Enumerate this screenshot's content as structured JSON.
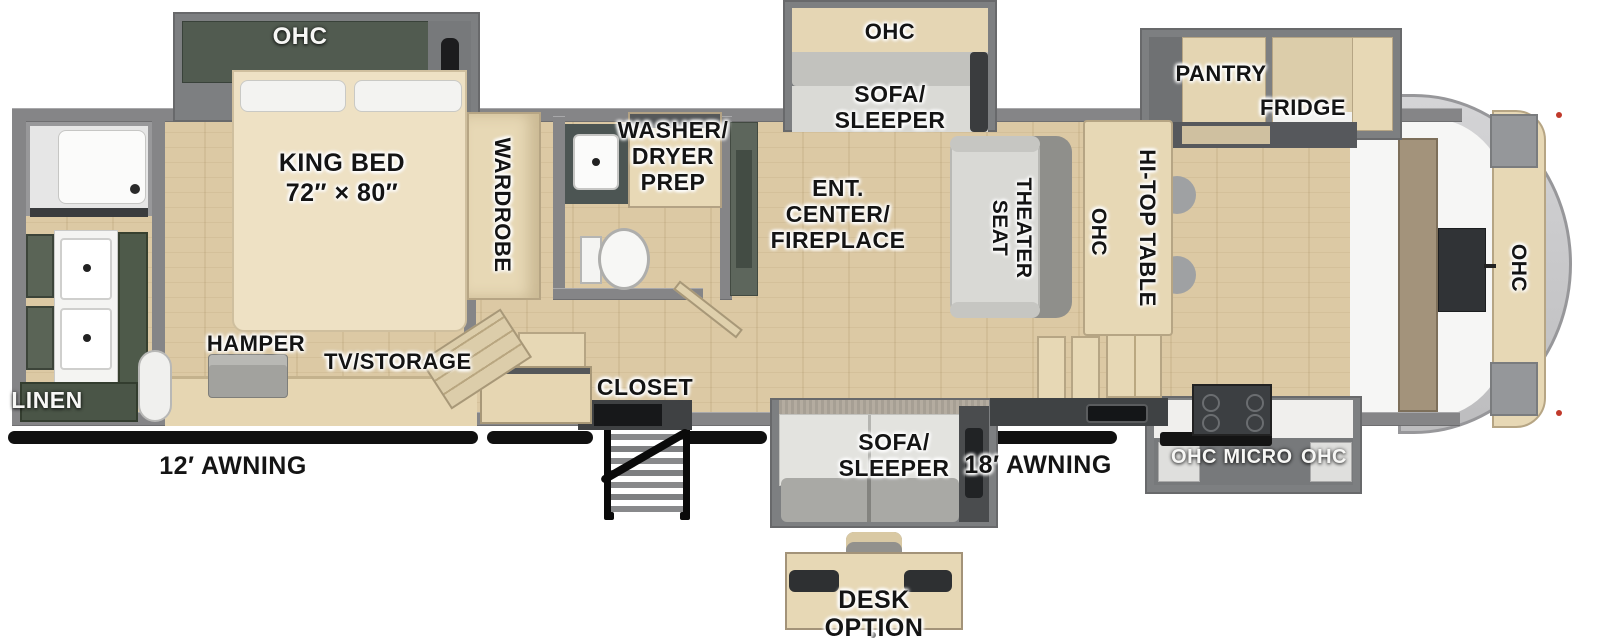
{
  "floorplan": {
    "bedroom": {
      "ohc": "OHC",
      "king_bed": "KING BED\n72″ × 80″",
      "wardrobe": "WARDROBE",
      "hamper": "HAMPER",
      "tv_storage": "TV/STORAGE"
    },
    "rear_bath": {
      "linen": "LINEN"
    },
    "mid_bath": {
      "washer_dryer": "WASHER/\nDRYER\nPREP"
    },
    "living": {
      "ent_center": "ENT.\nCENTER/\nFIREPLACE",
      "sofa_ohc": "OHC",
      "sofa_sleeper": "SOFA/\nSLEEPER",
      "theater_seat": "THEATER\nSEAT",
      "ohc": "OHC",
      "hitop_table": "HI-TOP TABLE"
    },
    "kitchen": {
      "pantry": "PANTRY",
      "fridge": "FRIDGE",
      "front_ohc": "OHC",
      "ohc_left": "OHC",
      "micro": "MICRO",
      "ohc_right": "OHC"
    },
    "entry": {
      "closet": "CLOSET"
    },
    "exterior": {
      "awning_12": "12′ AWNING",
      "awning_18": "18′ AWNING"
    },
    "options": {
      "sofa_sleeper": "SOFA/\nSLEEPER",
      "desk": "DESK OPTION"
    }
  },
  "colors": {
    "wall_gray": "#858587",
    "slide_gray": "#7d7f81",
    "floor_wood": "#dcc9a4",
    "cabinet_wood": "#e7d8b5",
    "cabinet_green": "#515b50",
    "bath_green": "#4a5547",
    "counter_dark": "#3f4244",
    "sofa_light": "#dadad6",
    "sofa_dark": "#a9a9a5",
    "awning_black": "#101010",
    "front_cap": "#c8c8ca",
    "label_dark": "#141414",
    "label_light": "#f7f7f5"
  }
}
